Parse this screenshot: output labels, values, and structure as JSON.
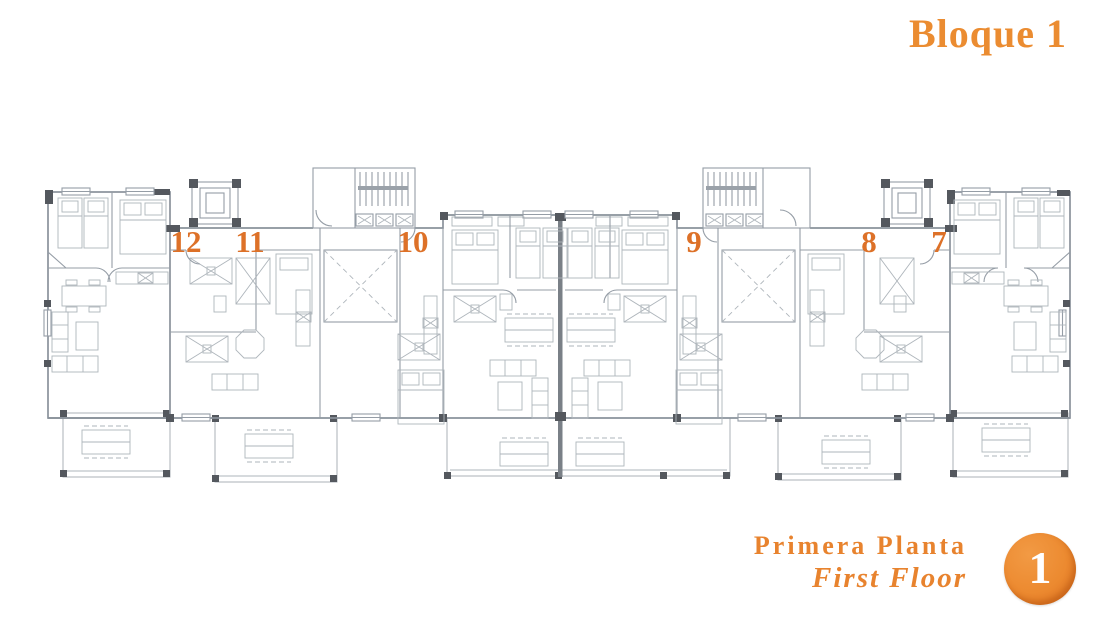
{
  "header": {
    "title": "Bloque 1"
  },
  "plan": {
    "units": [
      {
        "number": "12",
        "x": 186,
        "y": 242
      },
      {
        "number": "11",
        "x": 250,
        "y": 242
      },
      {
        "number": "10",
        "x": 413,
        "y": 242
      },
      {
        "number": "9",
        "x": 694,
        "y": 242
      },
      {
        "number": "8",
        "x": 869,
        "y": 242
      },
      {
        "number": "7",
        "x": 939,
        "y": 242
      }
    ]
  },
  "footer": {
    "floor_label_es": "Primera Planta",
    "floor_label_en": "First Floor",
    "floor_badge": "1"
  },
  "colors": {
    "accent_orange": "#E8832E",
    "unit_number_orange": "#DD7128",
    "badge_orange": "#EC8A30",
    "plan_line_gray": "#959DA6",
    "wall_dark_gray": "#54585E"
  }
}
